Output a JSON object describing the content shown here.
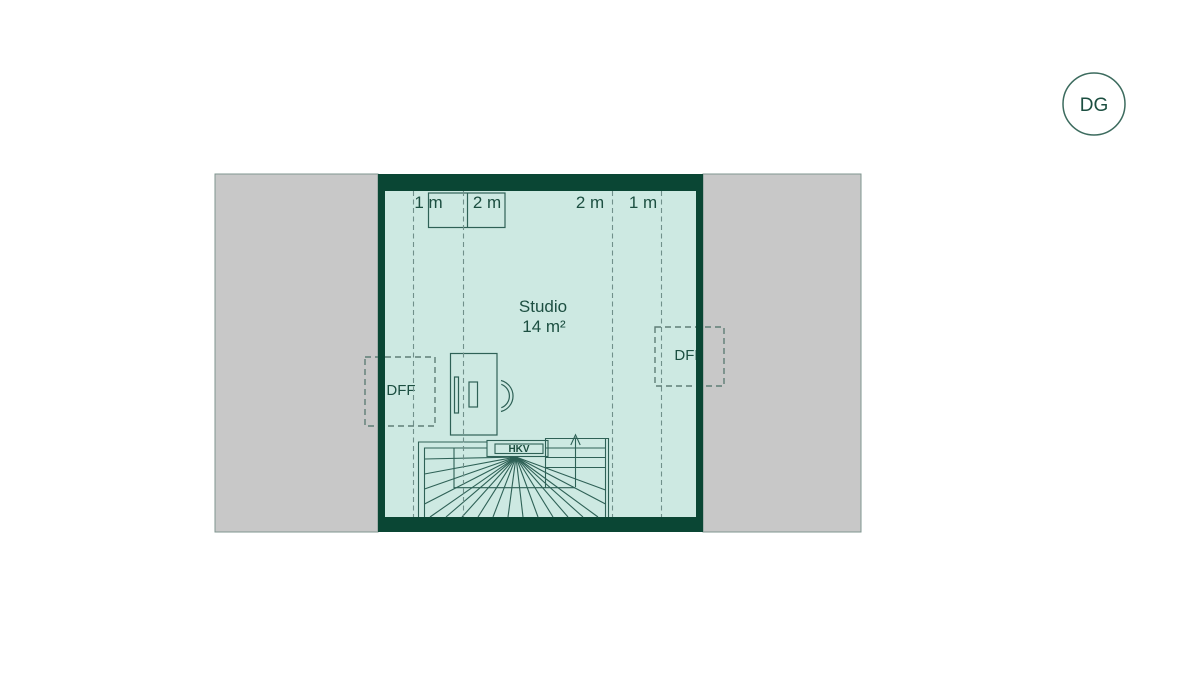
{
  "floor_badge": {
    "label": "DG"
  },
  "plan": {
    "room": {
      "name": "Studio",
      "area": "14 m²"
    },
    "dimension_labels": [
      "1 m",
      "2 m",
      "2 m",
      "1 m"
    ],
    "roof_windows": {
      "left_label": "DFF",
      "right_label": "DFF"
    },
    "heating_manifold": {
      "label": "HKV"
    },
    "colors": {
      "exterior_wall": "#0a4634",
      "room_floor": "#cde9e2",
      "roof_area": "#c8c8c8",
      "drawing_line": "#2e6156",
      "dashed_line": "#70908a",
      "text": "#1c4f41"
    }
  }
}
